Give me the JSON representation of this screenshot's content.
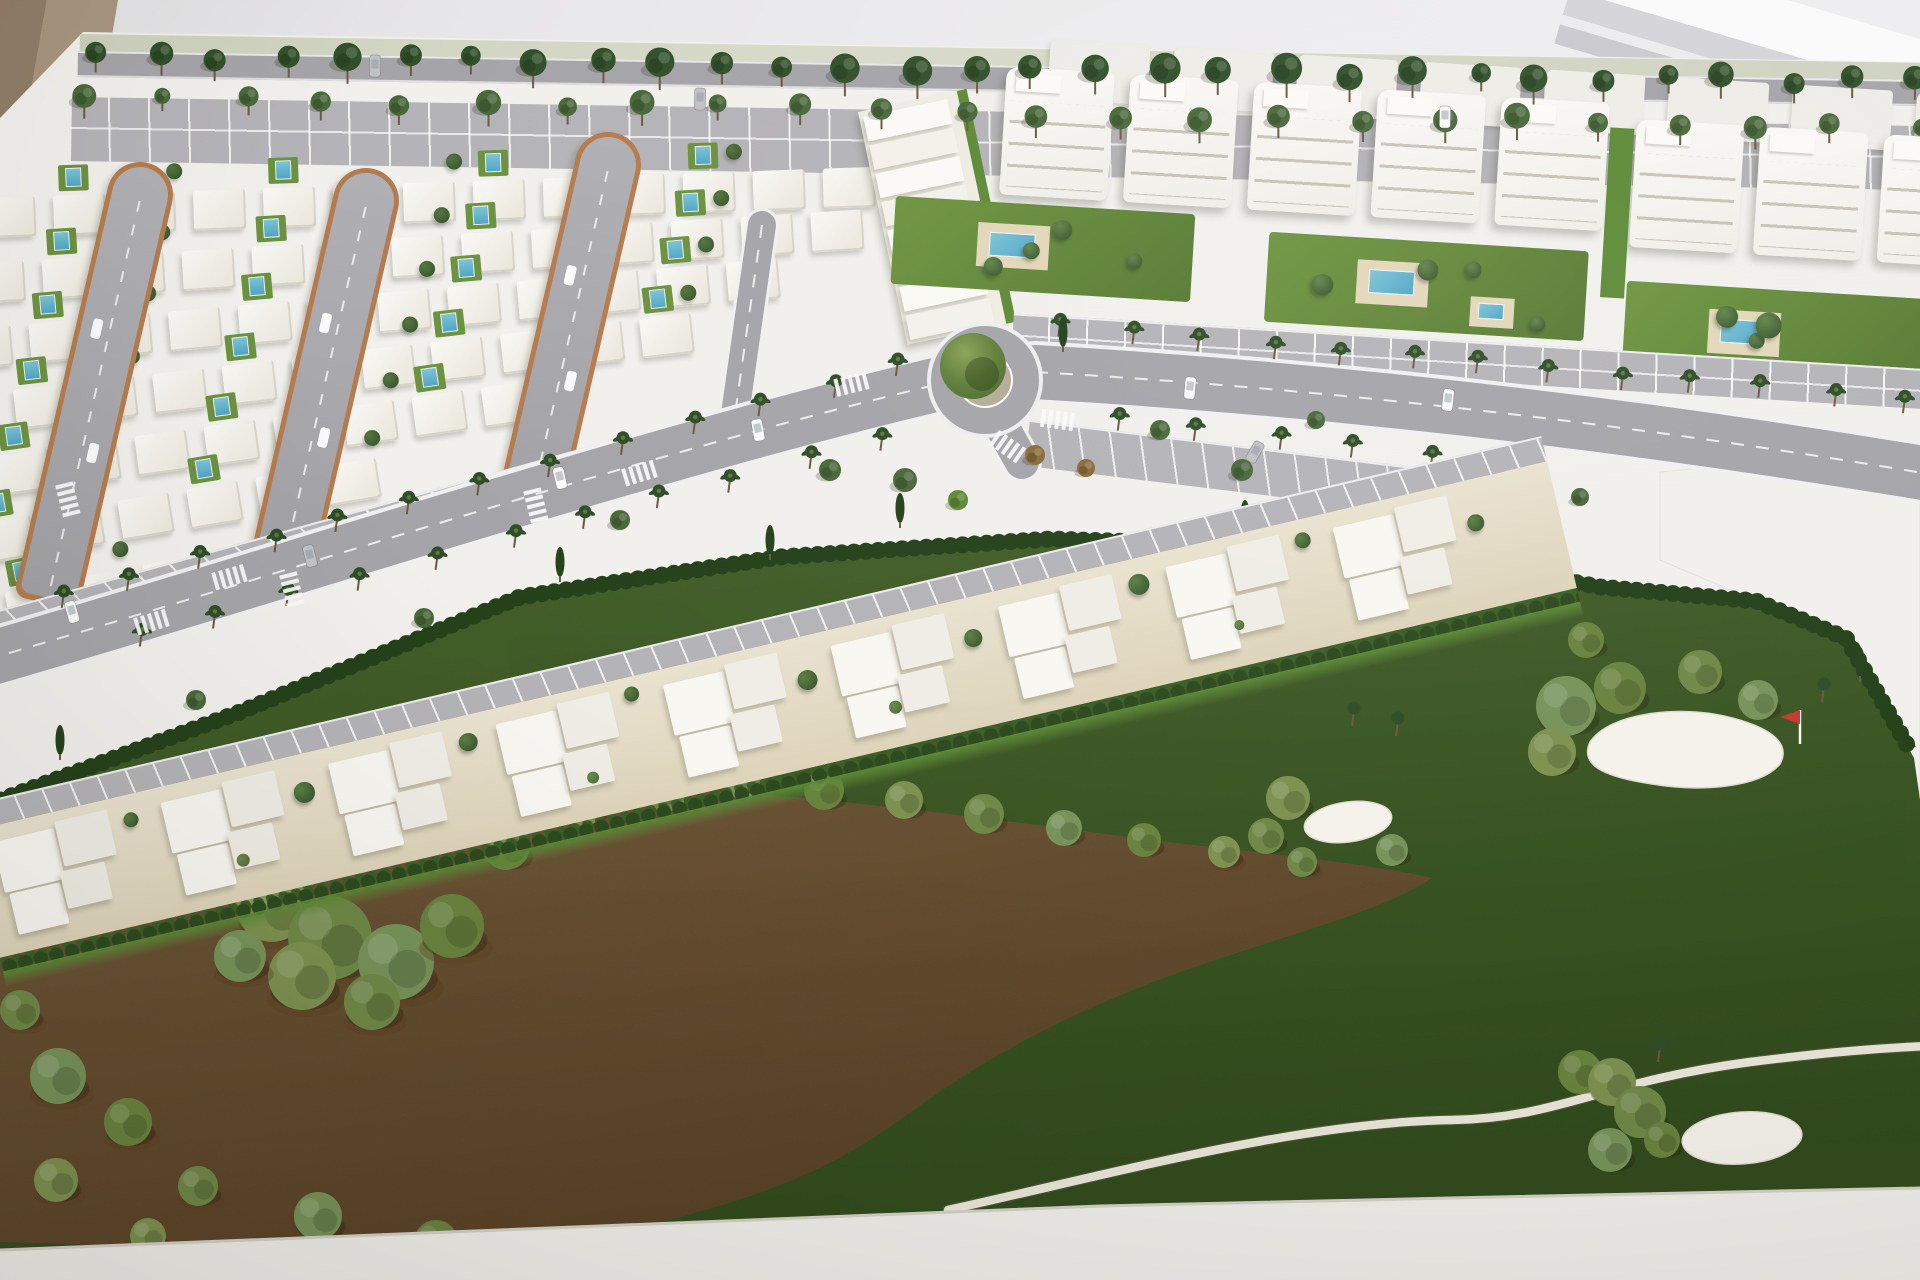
{
  "scene": {
    "label": "Photograph of an architectural scale model of a golf resort residential development with white model villas, apartment blocks, palm-lined avenue, roundabout and golf course",
    "width": 1920,
    "height": 1280
  },
  "palette": {
    "wall": "#e9e8ea",
    "beige": "#a7957f",
    "beigeDark": "#8f7d68",
    "stripe1": "#fafafb",
    "stripe2": "#d4d4d9",
    "stripe3": "#ececef",
    "stripe4": "#c9c9cf",
    "base": "#f1f0ec",
    "baseEdge": "#d5d2ca",
    "road": "#a5a5a9",
    "roadLight": "#b4b3b7",
    "lane": "#f0f0f1",
    "villa": "#f6f5f0",
    "apt": "#f7f6f2",
    "aptBack": "#edece7",
    "sand": "#e6dfca",
    "brick": "#b37c4e",
    "hedge": "#2c4a1e",
    "hedgeDark": "#24411a",
    "lawn": "#6b9240",
    "lawnBright": "#5d8a36",
    "golf": "#4d7030",
    "dirt": "#94734a",
    "dirtDark": "#5f3e1f",
    "pool": "#4fa5c4",
    "poolLight": "#7cc4d8",
    "poolDeck": "#e2d7b8",
    "treeDark": "#31502a",
    "treeMid": "#49683a",
    "treeOlive": "#7d9150",
    "treeBrown": "#8a6b3a",
    "palm": "#2f4d28",
    "trunk": "#6b5a3f",
    "bunker": "#f4f2ea",
    "cartPath": "#ebe7da",
    "carWhite": "#fafafa",
    "carGrey": "#c2c2c6",
    "flagRed": "#c23b2e",
    "island": "#b7ab97",
    "verge": "#ccd1bd"
  },
  "model": {
    "clip": "polygon(83px 32px,1920px 62px,1920px 1280px,0px 1280px,0px 118px)"
  },
  "beige_corner": {
    "clip": "polygon(0px 0px,118px 0px,96px 130px,0px 130px)"
  },
  "tree_rows": [
    [
      95,
      54,
      1915,
      82,
      30,
      12,
      "treeDark"
    ],
    [
      88,
      98,
      1915,
      126,
      24,
      10,
      "treeMid"
    ]
  ],
  "villa_rows": [
    [
      -18,
      168,
      13,
      70,
      -2
    ],
    [
      -30,
      234,
      13,
      70,
      -3.5
    ],
    [
      -44,
      300,
      12,
      70,
      -5
    ],
    [
      -60,
      368,
      11,
      70,
      -6.5
    ],
    [
      -78,
      436,
      9,
      70,
      -8
    ],
    [
      -95,
      506,
      7,
      70,
      -9.5
    ],
    [
      -70,
      576,
      4,
      70,
      -11
    ]
  ],
  "loops": [
    [
      140,
      162,
      452,
      13
    ],
    [
      366,
      168,
      416,
      13
    ],
    [
      608,
      132,
      382,
      13
    ]
  ],
  "terrace": {
    "x": 858,
    "y": 112,
    "w": 104,
    "h": 238,
    "angle": -12,
    "steps": 8
  },
  "apartments": {
    "x": 1000,
    "y": 50,
    "angle": 3.5,
    "back": [
      50,
      -14,
      8,
      124,
      100,
      60
    ],
    "groups": [
      [
        8,
        16,
        5,
        124,
        108,
        128
      ],
      [
        640,
        30,
        3,
        124,
        108,
        128
      ]
    ],
    "alley": [
      614,
      40,
      24,
      170
    ],
    "gardens": [
      [
        -95,
        152,
        300,
        88
      ],
      [
        280,
        165,
        320,
        90
      ],
      [
        640,
        192,
        300,
        95
      ]
    ],
    "parking": [
      30,
      262,
      1140,
      40
    ]
  },
  "townhouses": {
    "x": -36,
    "y": 806,
    "angle": -13.2,
    "w": 1620,
    "clusters": [
      9,
      20,
      172
    ],
    "parking_h": 26,
    "hedge_y": 156
  },
  "parking_west": {
    "x": -30,
    "y": 618,
    "w": 780,
    "h": 58,
    "angle": -15.5
  },
  "parking_east": {
    "x": 1030,
    "y": 420,
    "w": 430,
    "h": 46,
    "angle": 7
  },
  "roads": {
    "avenue_west": "M -15,660 C 280,575 640,455 935,385",
    "avenue_east": "M 1035,372 C 1260,385 1560,412 1935,475",
    "stub": "M 988,402 L 1022,462",
    "street": "M 762,225 L 732,435",
    "brick_edge": "M 60,628 C 350,545 650,470 860,408 C 920,390 962,372 1000,352",
    "roundabout": [
      985,
      380,
      54,
      27,
      33
    ]
  },
  "crosswalks": [
    [
      852,
      384,
      -14
    ],
    [
      1058,
      420,
      8
    ],
    [
      1008,
      447,
      35
    ],
    [
      640,
      473,
      -17
    ],
    [
      152,
      622,
      -17
    ],
    [
      68,
      500,
      76
    ],
    [
      292,
      590,
      76
    ],
    [
      536,
      506,
      76
    ],
    [
      230,
      577,
      -16
    ]
  ],
  "cars": [
    [
      72,
      612,
      -16,
      "carWhite"
    ],
    [
      310,
      556,
      -14,
      "carGrey"
    ],
    [
      560,
      478,
      -13,
      "carWhite"
    ],
    [
      758,
      430,
      -10,
      "carWhite"
    ],
    [
      1190,
      388,
      5,
      "carWhite"
    ],
    [
      1448,
      400,
      6,
      "carWhite"
    ],
    [
      1255,
      452,
      30,
      "carGrey"
    ],
    [
      375,
      66,
      1,
      "carGrey"
    ],
    [
      700,
      99,
      1,
      "carGrey"
    ],
    [
      1445,
      117,
      1,
      "carWhite"
    ]
  ],
  "palm_lines": [
    [
      60,
      610,
      900,
      378,
      13
    ],
    [
      140,
      648,
      880,
      452,
      11
    ],
    [
      1060,
      338,
      1900,
      412,
      13
    ],
    [
      1120,
      430,
      1430,
      468,
      5
    ]
  ],
  "scatter_trees": [
    [
      830,
      470,
      11,
      "treeMid"
    ],
    [
      905,
      480,
      12,
      "treeMid"
    ],
    [
      958,
      500,
      10,
      "lawnBright"
    ],
    [
      1160,
      430,
      10,
      "treeMid"
    ],
    [
      1242,
      470,
      11,
      "treeMid"
    ],
    [
      1316,
      420,
      9,
      "treeMid"
    ],
    [
      620,
      520,
      10,
      "treeMid"
    ],
    [
      424,
      618,
      10,
      "treeMid"
    ],
    [
      196,
      700,
      10,
      "treeMid"
    ],
    [
      1035,
      455,
      10,
      "treeBrown"
    ],
    [
      1086,
      468,
      9,
      "treeBrown"
    ],
    [
      1495,
      470,
      10,
      "treeMid"
    ],
    [
      1580,
      497,
      9,
      "treeMid"
    ]
  ],
  "cypresses": [
    [
      560,
      562
    ],
    [
      770,
      540
    ],
    [
      900,
      508
    ],
    [
      1245,
      515
    ],
    [
      1420,
      505
    ],
    [
      1860,
      662
    ],
    [
      60,
      740
    ],
    [
      1063,
      332
    ]
  ],
  "golf": {
    "poly": "M 0,802 L 240,714 L 520,598 L 780,558 L 1050,540 L 1300,548 L 1480,566 L 1600,588 L 1756,602 L 1848,640 L 1914,758 L 1920,800 L 1920,1192 L 1450,1200 L 1100,1208 L 600,1228 L 0,1254 Z",
    "hedge": "M 0,800 L 240,712 L 520,597 L 780,557 L 1050,539 L 1300,547 L 1480,565 L 1600,587 L 1756,601 L 1846,638 L 1910,750",
    "white_plot": "M 1660,472 L 1920,448 L 1920,795 L 1908,756 L 1846,638 L 1754,600 L 1660,560 Z",
    "dirt": "M 0,908 C 120,888 260,872 380,856 C 520,812 600,795 700,790 C 850,800 1000,820 1150,840 C 1250,852 1360,862 1432,878 C 1380,912 1300,930 1180,972 C 1060,1016 980,1060 900,1120 C 820,1176 760,1196 640,1228 C 520,1258 300,1250 140,1246 L 0,1242 Z",
    "cart_path": "M 948,1210 C 1120,1172 1300,1122 1452,1120 C 1560,1118 1600,1082 1750,1062 C 1830,1052 1880,1048 1930,1046",
    "bunker1": [
      1348,
      822,
      44,
      20,
      -8
    ],
    "bunker2": "M 1590,742 C 1610,712 1680,706 1724,716 C 1768,726 1792,742 1780,764 C 1760,788 1700,792 1652,784 C 1612,778 1578,768 1590,742 Z",
    "bunker3": [
      1742,
      1138,
      60,
      26,
      -4
    ],
    "flag": [
      1800,
      744,
      34
    ],
    "green_trees": [
      [
        332,
        780,
        13
      ],
      [
        376,
        828,
        12
      ]
    ],
    "small_palms": [
      [
        1352,
        726
      ],
      [
        1396,
        736
      ],
      [
        1658,
        1062
      ],
      [
        1822,
        702
      ]
    ],
    "bushes": [
      [
        272,
        906,
        36
      ],
      [
        330,
        938,
        42
      ],
      [
        396,
        962,
        38
      ],
      [
        452,
        926,
        32
      ],
      [
        302,
        976,
        34
      ],
      [
        372,
        1002,
        28
      ],
      [
        240,
        956,
        26
      ],
      [
        506,
        846,
        24
      ],
      [
        584,
        806,
        20
      ],
      [
        666,
        790,
        22
      ],
      [
        744,
        781,
        19
      ],
      [
        824,
        790,
        20
      ],
      [
        904,
        800,
        19
      ],
      [
        984,
        814,
        20
      ],
      [
        1064,
        828,
        18
      ],
      [
        1144,
        840,
        17
      ],
      [
        1224,
        852,
        16
      ],
      [
        1302,
        862,
        15
      ],
      [
        58,
        1076,
        28
      ],
      [
        128,
        1122,
        24
      ],
      [
        56,
        1180,
        22
      ],
      [
        198,
        1186,
        20
      ],
      [
        318,
        1216,
        24
      ],
      [
        436,
        1242,
        22
      ],
      [
        148,
        1236,
        18
      ],
      [
        20,
        1010,
        20
      ],
      [
        1566,
        706,
        30
      ],
      [
        1620,
        688,
        26
      ],
      [
        1552,
        752,
        24
      ],
      [
        1700,
        672,
        22
      ],
      [
        1758,
        700,
        20
      ],
      [
        1586,
        640,
        18
      ],
      [
        1288,
        798,
        22
      ],
      [
        1266,
        836,
        18
      ],
      [
        1392,
        850,
        16
      ],
      [
        1580,
        1072,
        22
      ],
      [
        1612,
        1082,
        24
      ],
      [
        1640,
        1112,
        26
      ],
      [
        1610,
        1150,
        22
      ],
      [
        1662,
        1140,
        18
      ]
    ]
  },
  "base_band": {
    "path": "M 0,1250 L 600,1226 L 1100,1206 L 1450,1198 L 1920,1188 L 1920,1280 L 0,1280 Z",
    "edge": "M 0,1250 L 600,1226 L 1100,1206 L 1450,1198 L 1920,1188"
  }
}
